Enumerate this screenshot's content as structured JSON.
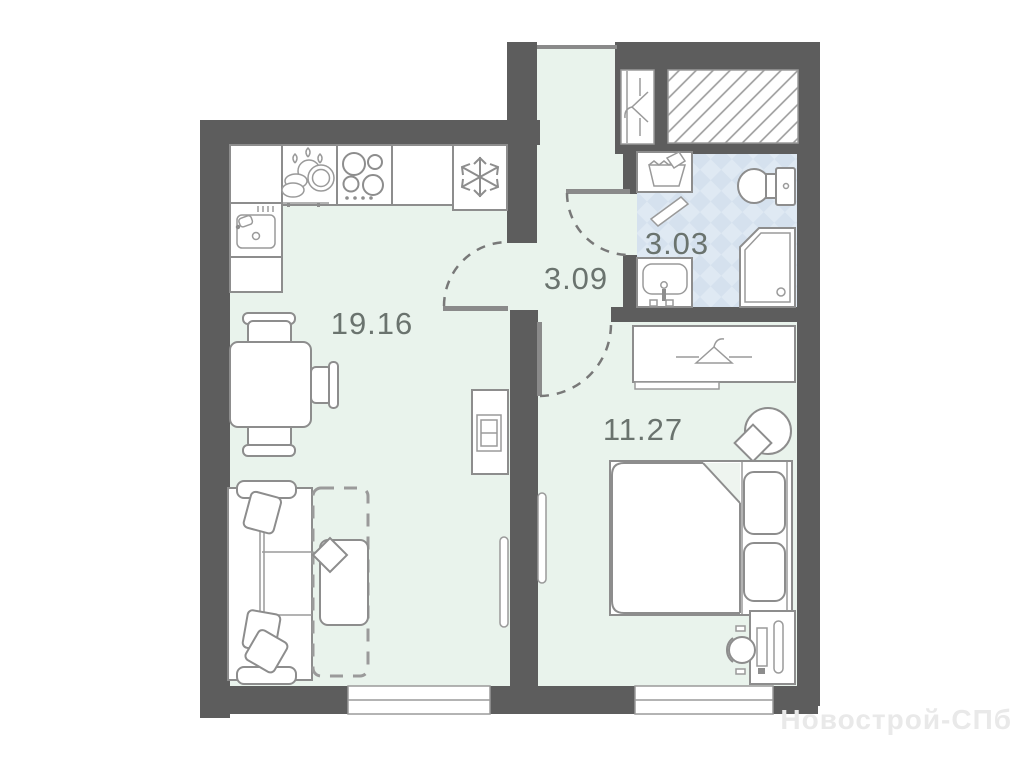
{
  "floorplan": {
    "rooms": [
      {
        "name": "kitchen-living-room",
        "area": "19.16"
      },
      {
        "name": "hallway",
        "area": "3.09"
      },
      {
        "name": "bathroom",
        "area": "3.03"
      },
      {
        "name": "bedroom",
        "area": "11.27"
      }
    ],
    "watermark": "Новострой-СПб",
    "colors": {
      "wall": "#5d5d5d",
      "floor": "#e9f3ec",
      "bathroom_tile": "#dfe9f3",
      "bathroom_tile_alt": "#d5e1ee",
      "furniture_outline": "#8d8d8d",
      "label_text": "#6a736e",
      "watermark_text": "#e9e9e9"
    },
    "icons": [
      "snowflake-fridge-icon",
      "stove-burners-icon",
      "dishes-icon",
      "kitchen-sink-icon",
      "tv-icon",
      "hanger-icon",
      "ventilation-shaft-hatch",
      "washing-machine-icon",
      "toilet-icon",
      "shower-icon",
      "washbasin-icon",
      "door-swing-arc"
    ]
  }
}
